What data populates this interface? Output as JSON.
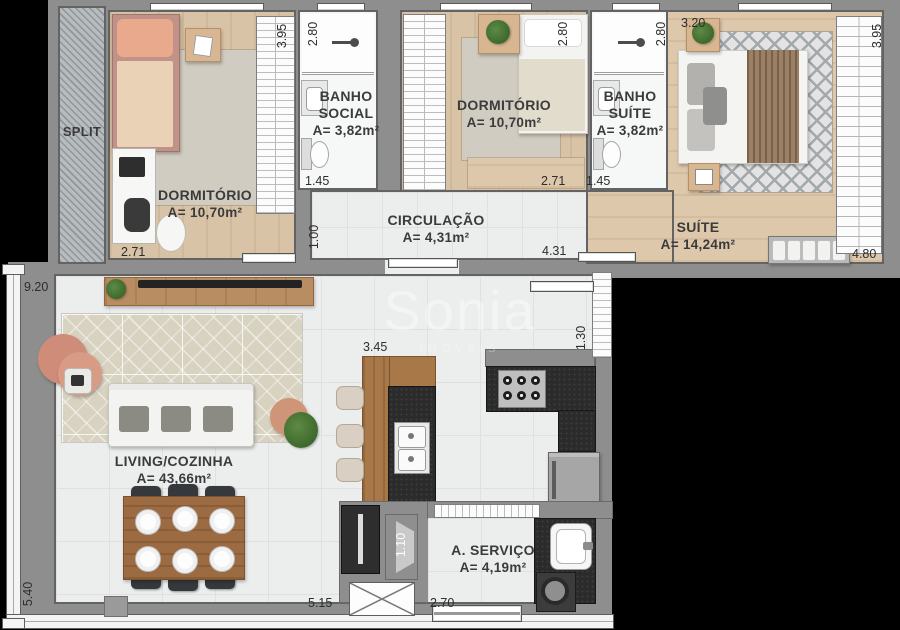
{
  "watermark": {
    "brand": "Sonia",
    "tagline": "IMÓVEIS"
  },
  "rooms": {
    "split": {
      "label": "SPLIT"
    },
    "dorm1": {
      "name": "DORMITÓRIO",
      "area": "A= 10,70m²"
    },
    "banho_social": {
      "line1": "BANHO",
      "line2": "SOCIAL",
      "area": "A= 3,82m²"
    },
    "dorm2": {
      "name": "DORMITÓRIO",
      "area": "A= 10,70m²"
    },
    "banho_suite": {
      "line1": "BANHO",
      "line2": "SUÍTE",
      "area": "A= 3,82m²"
    },
    "suite": {
      "name": "SUÍTE",
      "area": "A= 14,24m²"
    },
    "circulacao": {
      "name": "CIRCULAÇÃO",
      "area": "A= 4,31m²"
    },
    "living": {
      "name": "LIVING/COZINHA",
      "area": "A= 43,66m²"
    },
    "servico": {
      "name": "A. SERVIÇO",
      "area": "A= 4,19m²"
    }
  },
  "dims": {
    "dorm1_depth": "3.95",
    "banho_social_width": "2.80",
    "dorm2_width": "2.80",
    "banho_suite_width": "2.80",
    "suite_top": "3.20",
    "suite_depth": "3.95",
    "dorm1_width": "2.71",
    "banho_social_inner": "1.45",
    "dorm2_inner": "2.71",
    "banho_suite_inner": "1.45",
    "circ_height": "1.00",
    "circ_width": "4.31",
    "suite_right": "4.80",
    "living_top": "9.20",
    "living_left": "5.40",
    "island": "3.45",
    "kitchen_window": "1.30",
    "shaft": "1.10",
    "living_bottom": "5.15",
    "servico_width": "2.70"
  },
  "colors": {
    "background": "#000000",
    "wall": "#8e8e8e",
    "floor_tile": "#eceded",
    "wood_floor": "#d9c3a6",
    "counter_granite": "#2b2b2b",
    "cabinet_wood": "#9c6b42",
    "pouf_accent": "#cf8d79",
    "label_text": "#3b3b3b"
  }
}
